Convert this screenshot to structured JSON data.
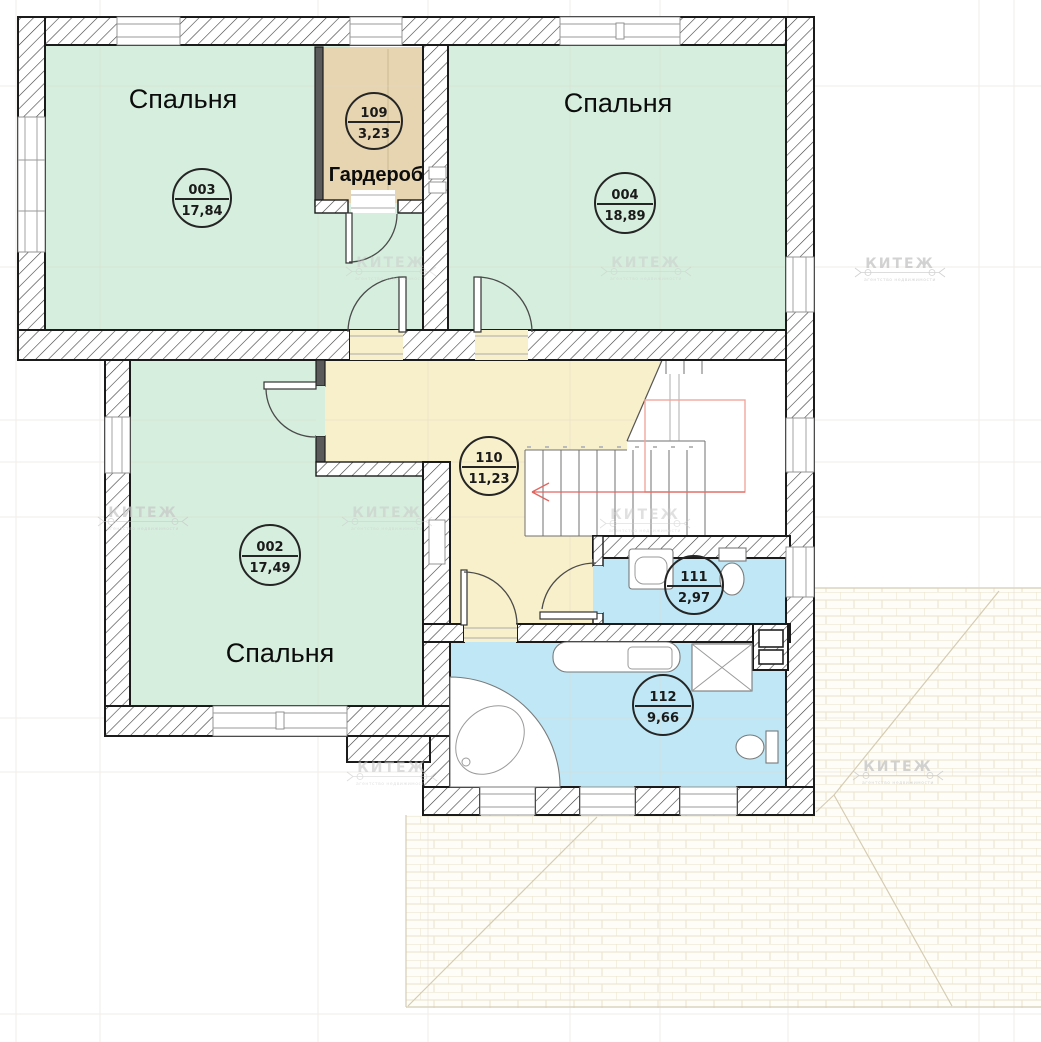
{
  "rooms": {
    "bedroom_003": {
      "label": "Спальня",
      "number": "003",
      "area": "17,84"
    },
    "wardrobe_109": {
      "label": "Гардероб",
      "number": "109",
      "area": "3,23"
    },
    "bedroom_004": {
      "label": "Спальня",
      "number": "004",
      "area": "18,89"
    },
    "bedroom_002": {
      "label": "Спальня",
      "number": "002",
      "area": "17,49"
    },
    "hall_110": {
      "number": "110",
      "area": "11,23"
    },
    "bathroom_111": {
      "number": "111",
      "area": "2,97"
    },
    "bathroom_112": {
      "number": "112",
      "area": "9,66"
    }
  },
  "watermark": {
    "text": "КИТЕЖ",
    "subtext": "агентство недвижимости"
  },
  "colors": {
    "bedroom": "#d6eedd",
    "wardrobe": "#e7d5b1",
    "hall": "#f8f0ca",
    "bathroom": "#bfe7f5",
    "wall": "#1b1b1b",
    "stair_arrow": "#e06660",
    "stair_opening": "#f2a59e",
    "roof_line": "#d5ccb2"
  }
}
